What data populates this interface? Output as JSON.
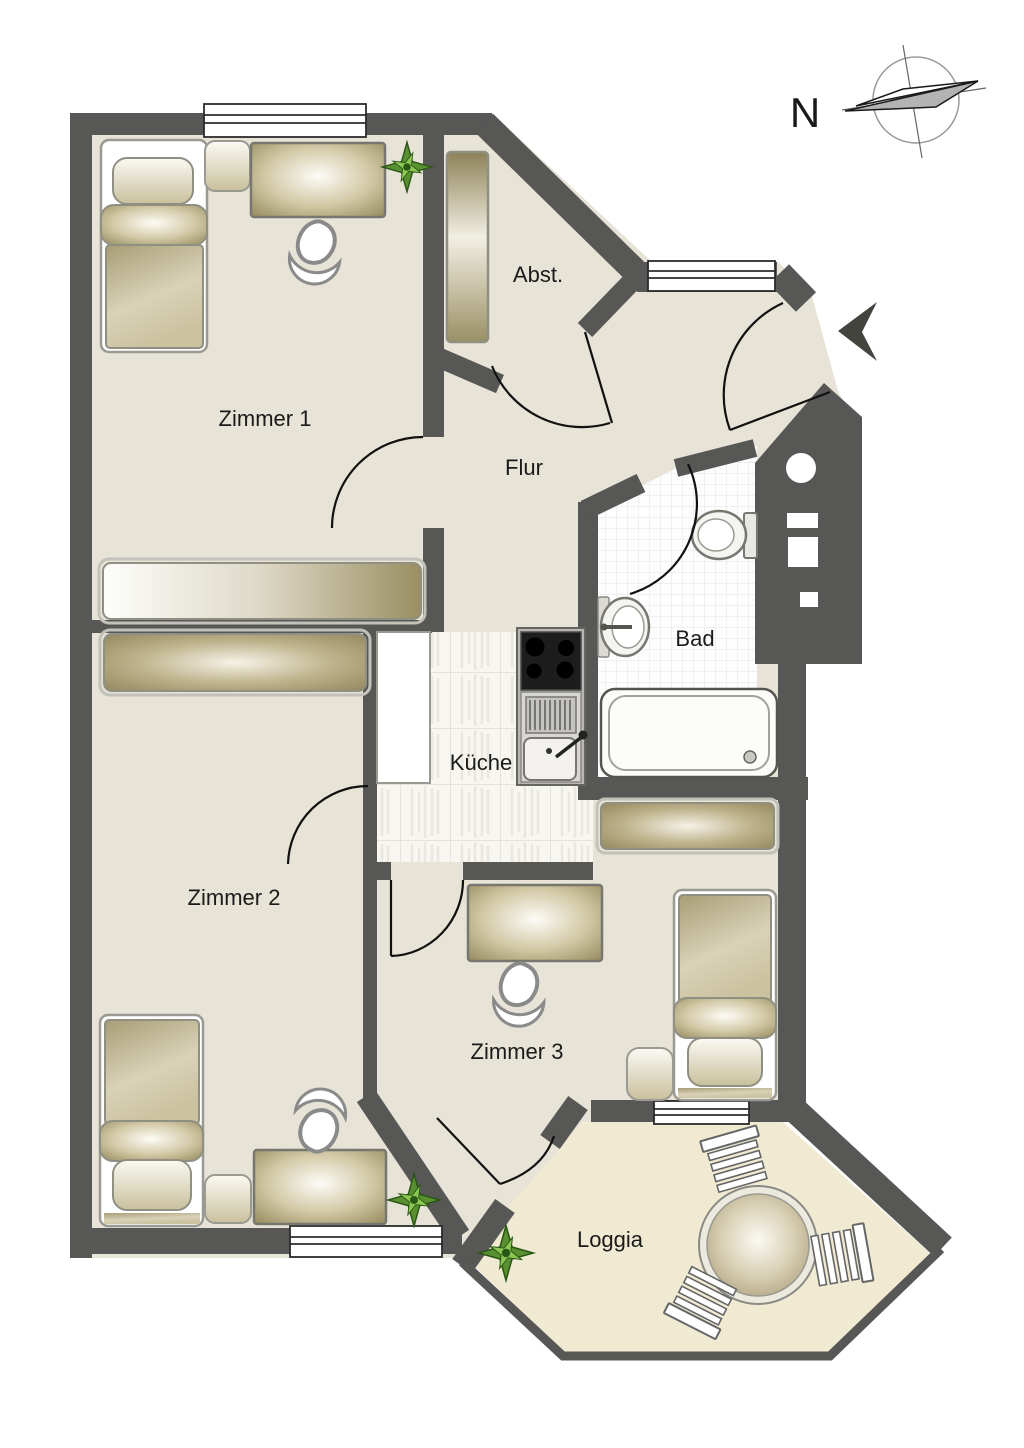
{
  "plan": {
    "type": "apartment-floor-plan",
    "rooms": {
      "zimmer1": {
        "label": "Zimmer 1"
      },
      "zimmer2": {
        "label": "Zimmer 2"
      },
      "zimmer3": {
        "label": "Zimmer 3"
      },
      "flur": {
        "label": "Flur"
      },
      "abstellraum": {
        "label": "Abst."
      },
      "bad": {
        "label": "Bad"
      },
      "kueche": {
        "label": "Küche"
      },
      "loggia": {
        "label": "Loggia"
      }
    }
  },
  "compass": {
    "north_label": "N"
  },
  "colors": {
    "wall": "#575756",
    "floor": "#e7e3d6",
    "floorLoggia": "#f0ead3",
    "tileBath": "#fdfdfd",
    "tileKitchen": "#f7f6f1",
    "ink": "#1a1a1a"
  }
}
